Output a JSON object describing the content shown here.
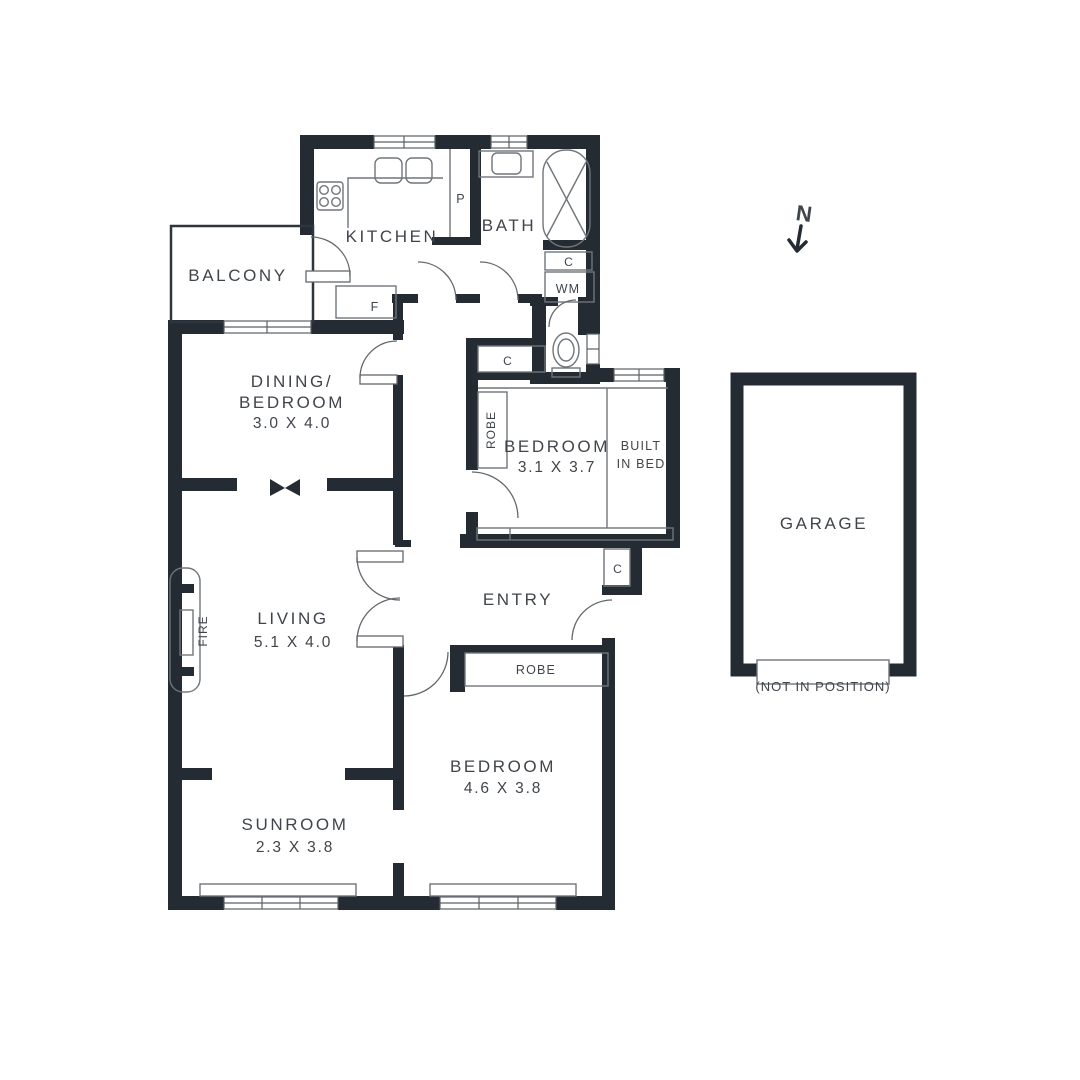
{
  "rooms": {
    "balcony": {
      "label": "BALCONY"
    },
    "kitchen": {
      "label": "KITCHEN"
    },
    "bath": {
      "label": "BATH"
    },
    "dining": {
      "line1": "DINING/",
      "line2": "BEDROOM",
      "dims": "3.0 X 4.0"
    },
    "bedroom3": {
      "label": "BEDROOM",
      "dims": "3.1 X 3.7"
    },
    "built_in_bed": {
      "line1": "BUILT",
      "line2": "IN BED"
    },
    "living": {
      "label": "LIVING",
      "dims": "5.1 X 4.0"
    },
    "entry": {
      "label": "ENTRY"
    },
    "bedroom4": {
      "label": "BEDROOM",
      "dims": "4.6 X 3.8"
    },
    "sunroom": {
      "label": "SUNROOM",
      "dims": "2.3 X 3.8"
    },
    "garage": {
      "label": "GARAGE",
      "note": "(NOT IN POSITION)"
    }
  },
  "fixtures": {
    "pantry": "P",
    "fridge": "F",
    "cupboard": "C",
    "washing_machine": "WM",
    "robe": "ROBE",
    "fireplace": "FIRE"
  },
  "compass": {
    "north": "N"
  },
  "colors": {
    "wall": "#242b33",
    "fixture_line": "#70757a",
    "door_line": "#63676b",
    "text": "#40454b",
    "background": "#ffffff"
  }
}
